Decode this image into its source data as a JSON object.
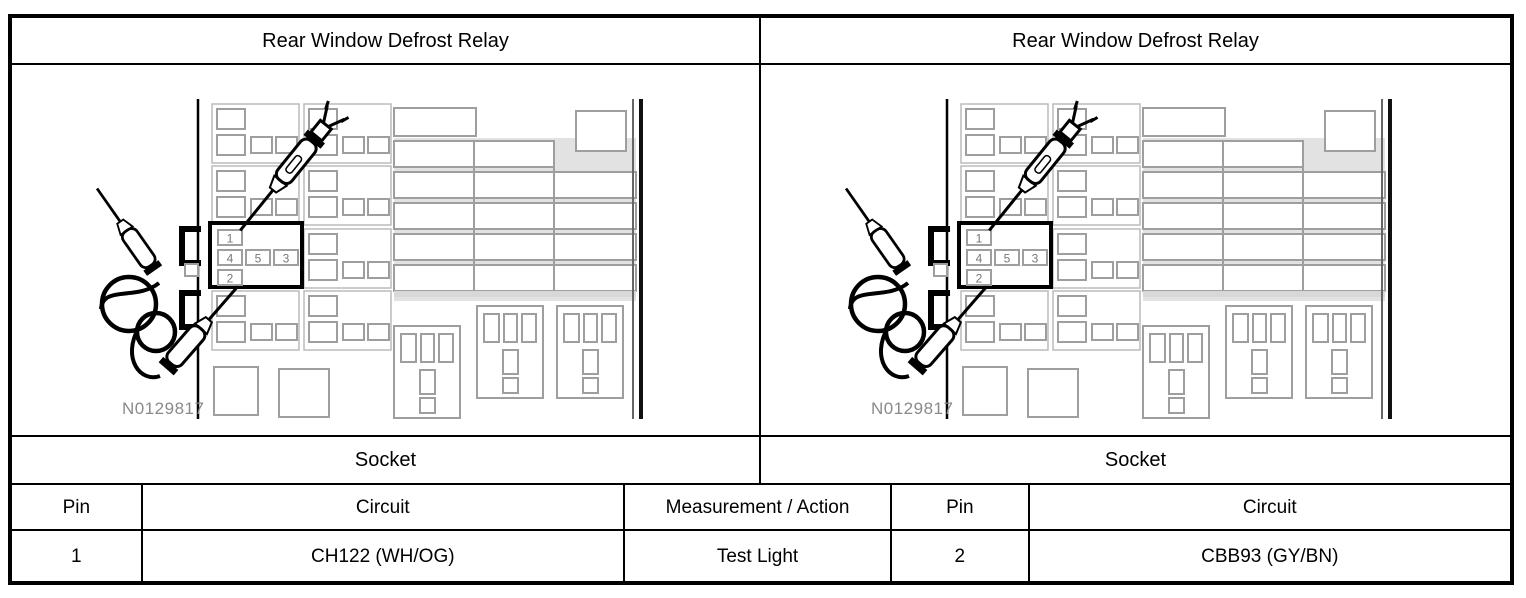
{
  "panels": [
    {
      "title": "Rear Window Defrost Relay",
      "socket_label": "Socket"
    },
    {
      "title": "Rear Window Defrost Relay",
      "socket_label": "Socket"
    }
  ],
  "diagram": {
    "figure_id": "N0129817",
    "relay_pins": {
      "pin1": "1",
      "pin4": "4",
      "pin5": "5",
      "pin3": "3",
      "pin2": "2"
    }
  },
  "table": {
    "headers": {
      "pin_left": "Pin",
      "circuit_left": "Circuit",
      "measurement": "Measurement / Action",
      "pin_right": "Pin",
      "circuit_right": "Circuit"
    },
    "row": {
      "pin_left": "1",
      "circuit_left": "CH122 (WH/OG)",
      "measurement": "Test Light",
      "pin_right": "2",
      "circuit_right": "CBB93 (GY/BN)"
    }
  },
  "colors": {
    "line_black": "#000000",
    "fuse_outline": "#9e9e9e",
    "panel_outline": "#bbbbbb",
    "highlight_band": "#d8d8d8",
    "figure_label_gray": "#8a8a8a"
  }
}
